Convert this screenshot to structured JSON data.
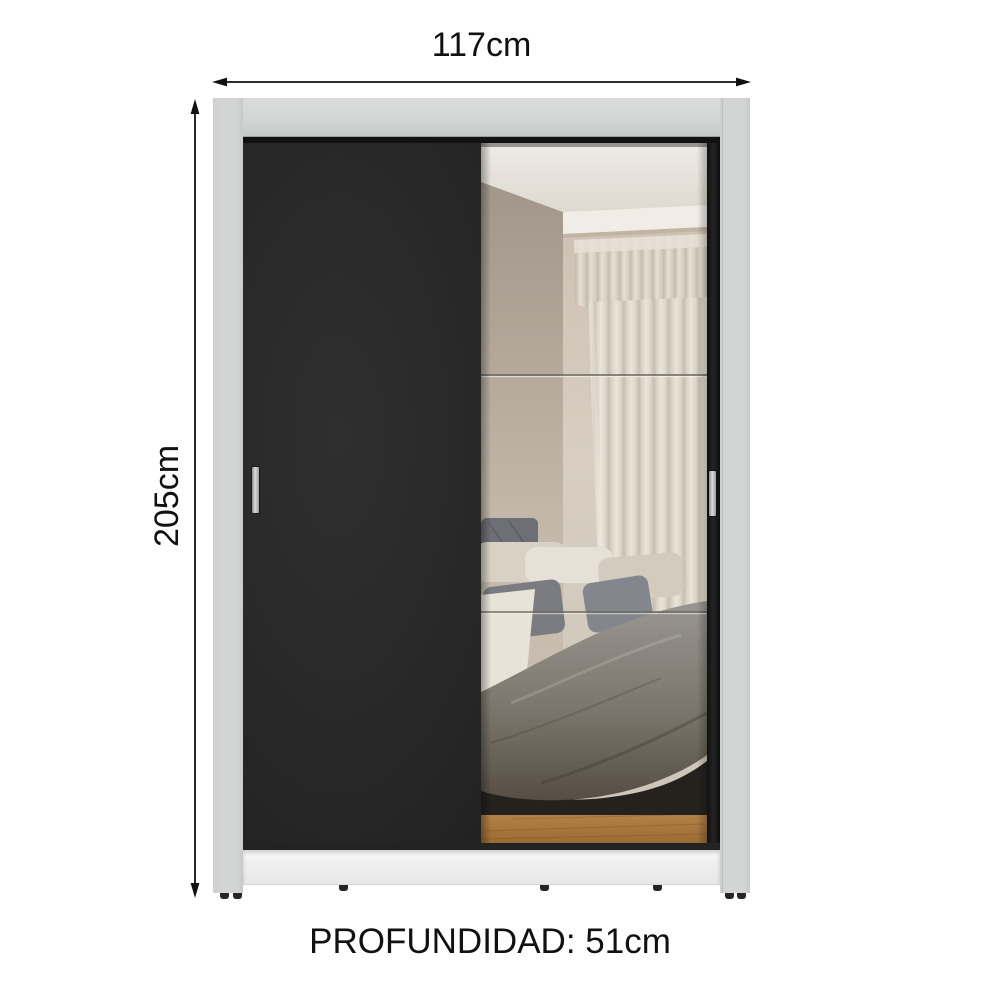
{
  "title": "Wardrobe 2 sliding doors - dimensions diagram",
  "dimensions": {
    "width": "117cm",
    "height": "205cm",
    "depth": "PROFUNDIDAD: 51cm"
  },
  "colors": {
    "background": "#ffffff",
    "text": "#111111",
    "arrow": "#111111",
    "frame": "#d3d5d4",
    "frame_seam": "#bcbebd",
    "door_black": "#272727",
    "door_track": "#161616",
    "plinth": "#f0f1f0",
    "handle": "#d9d9d9",
    "feet": "#262626",
    "mirror_wall_beige": "#d2c8ba",
    "mirror_curtain_cream": "#e0d9cc",
    "mirror_blanket_gray": "#7b766d",
    "mirror_floor_wood": "#a97a3f"
  }
}
